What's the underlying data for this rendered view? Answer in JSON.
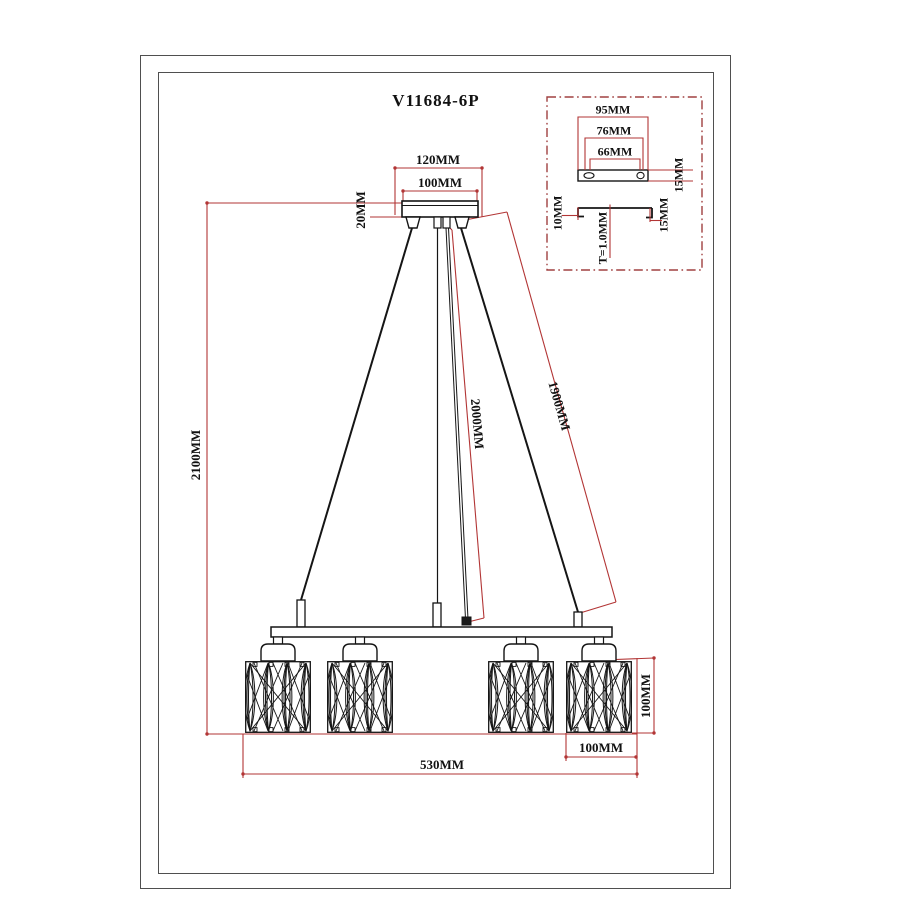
{
  "title": "V11684-6P",
  "colors": {
    "dimension": "#b23535",
    "drawing": "#151515",
    "detail_border": "#a04040"
  },
  "main_view": {
    "canopy_width_outer": "120MM",
    "canopy_width_inner": "100MM",
    "canopy_height": "20MM",
    "overall_height": "2100MM",
    "center_wire_length": "2000MM",
    "side_wire_length": "1900MM",
    "ring_width": "530MM",
    "shade_width": "100MM",
    "shade_height": "100MM"
  },
  "detail_view": {
    "plate_width": "95MM",
    "hole_spacing_outer": "76MM",
    "hole_spacing_inner": "66MM",
    "plate_height": "15MM",
    "flange_left": "10MM",
    "thickness": "T=1.0MM",
    "flange_right": "15MM"
  }
}
